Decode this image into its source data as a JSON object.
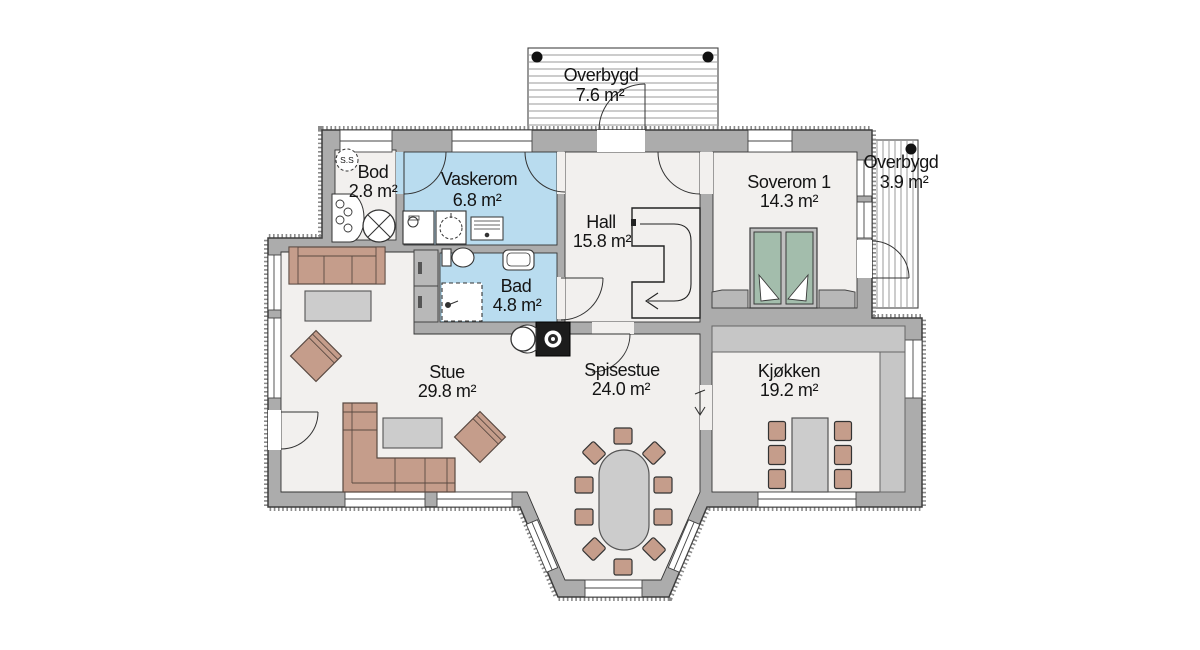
{
  "plan": {
    "symbols": {
      "ss": "S.S"
    },
    "colors": {
      "wall": "#acacac",
      "wall_edge": "#3c3c3c",
      "floor": "#f2f0ee",
      "wet_room": "#b9dcef",
      "mattress": "#a3bdac",
      "wood_furniture": "#c59d8b",
      "table": "#cccccc",
      "counter": "#c6c6c6",
      "deck_line": "#9a9a9a"
    },
    "rooms": [
      {
        "id": "overbygd_top",
        "name": "Overbygd",
        "area": "7.6 m²"
      },
      {
        "id": "overbygd_right",
        "name": "Overbygd",
        "area": "3.9 m²"
      },
      {
        "id": "bod",
        "name": "Bod",
        "area": "2.8 m²"
      },
      {
        "id": "vaskerom",
        "name": "Vaskerom",
        "area": "6.8 m²"
      },
      {
        "id": "hall",
        "name": "Hall",
        "area": "15.8 m²"
      },
      {
        "id": "soverom1",
        "name": "Soverom 1",
        "area": "14.3 m²"
      },
      {
        "id": "bad",
        "name": "Bad",
        "area": "4.8 m²"
      },
      {
        "id": "stue",
        "name": "Stue",
        "area": "29.8 m²"
      },
      {
        "id": "spisestue",
        "name": "Spisestue",
        "area": "24.0 m²"
      },
      {
        "id": "kjokken",
        "name": "Kjøkken",
        "area": "19.2 m²"
      }
    ]
  }
}
